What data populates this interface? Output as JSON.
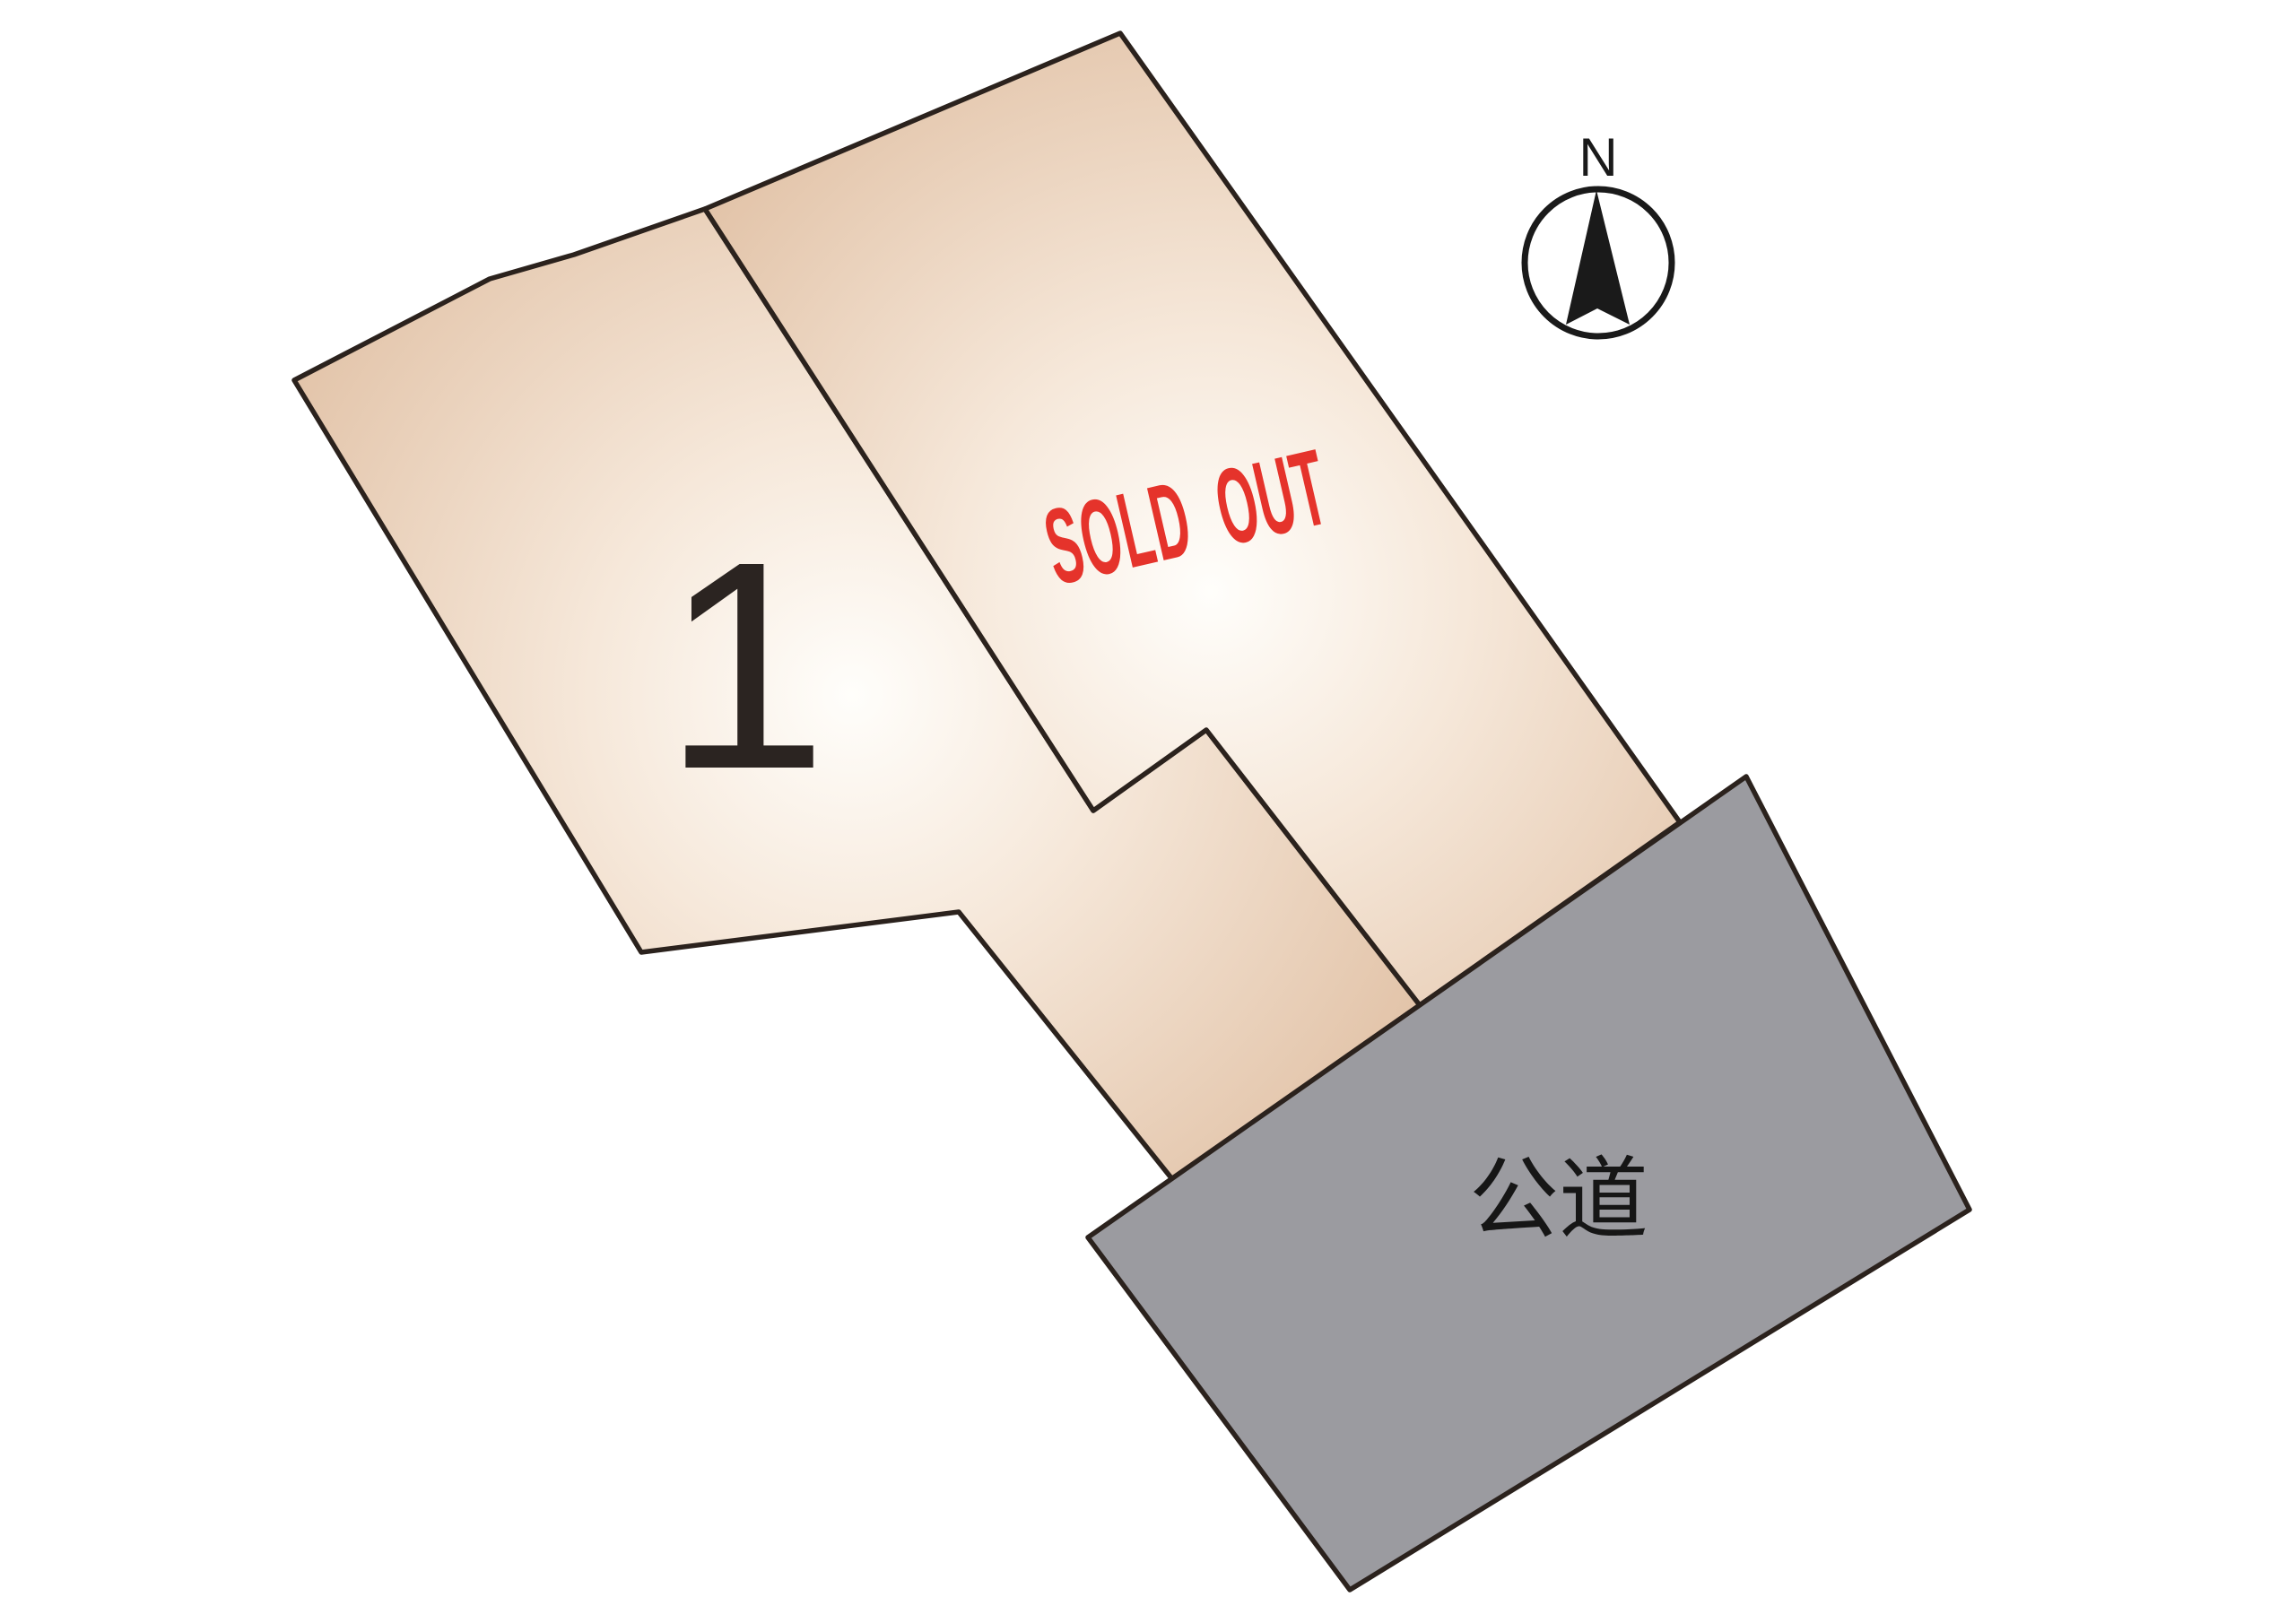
{
  "lots": [
    {
      "label": "1"
    },
    {
      "label": "SOLD OUT"
    }
  ],
  "road": {
    "label": "公道"
  },
  "compass": {
    "label": "N"
  },
  "colors": {
    "background": "#ffffff",
    "outline": "#2b221d",
    "parcel_center": "#fffefb",
    "parcel_mid": "#f6e8da",
    "parcel_edge": "#e2c3a8",
    "road_fill": "#9b9ba0",
    "sold_out_red": "#e5332b",
    "lot_number_color": "#2b2421",
    "road_label_color": "#161616",
    "compass_color": "#1a1a1a"
  }
}
